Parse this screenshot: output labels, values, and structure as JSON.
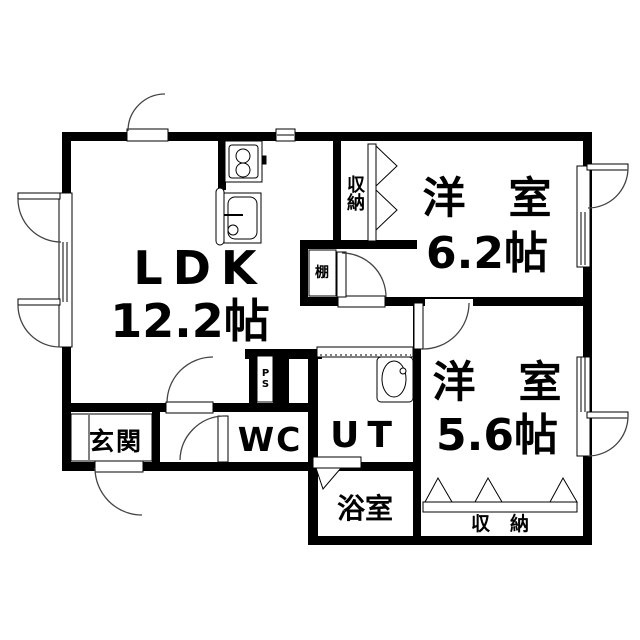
{
  "colors": {
    "wall": "#000000",
    "background": "#ffffff",
    "arc": "#333333"
  },
  "rooms": {
    "ldk": {
      "label": "LDK",
      "size": "12.2帖"
    },
    "bedroom_62": {
      "label": "洋　室",
      "size": "6.2帖"
    },
    "bedroom_56": {
      "label": "洋　室",
      "size": "5.6帖"
    },
    "entrance": {
      "label": "玄関"
    },
    "toilet": {
      "label": "WC"
    },
    "utility": {
      "label": "UT"
    },
    "bathroom": {
      "label": "浴室"
    }
  },
  "storage": {
    "closet_62": {
      "label": "収納"
    },
    "closet_56": {
      "label": "収納"
    },
    "shelf": {
      "label": "棚"
    },
    "pipe_space": {
      "label": "PS"
    }
  }
}
